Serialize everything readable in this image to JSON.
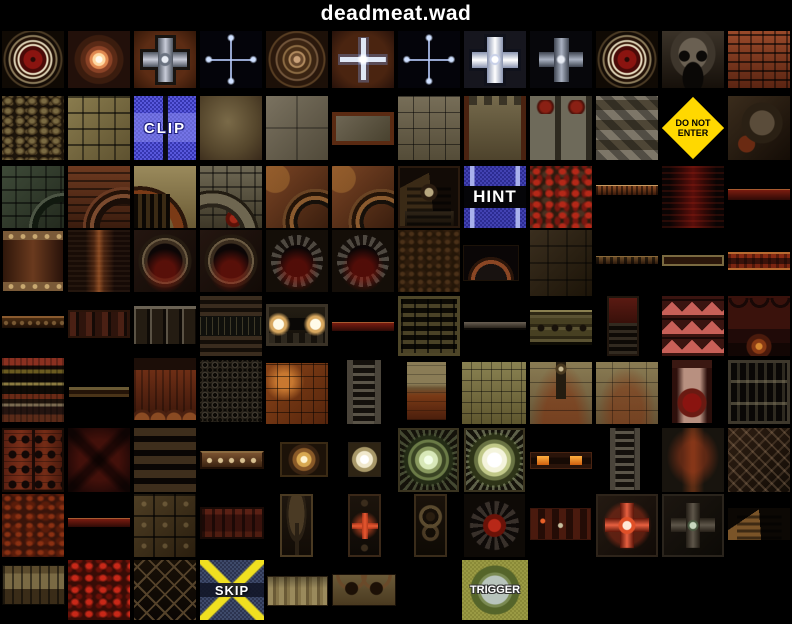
{
  "page": {
    "title": "deadmeat.wad"
  },
  "palette": {
    "background": "#000000",
    "title_text": "#ffffff",
    "clip_blue": "#4a4ad0",
    "hint_blue": "#3a3aa8",
    "warning_yellow": "#ffd800",
    "skip_navy": "#36405e",
    "skip_yellow": "#f0e020",
    "trigger_olive": "#90903c",
    "label_text": "#ffffff"
  },
  "tiles": [
    {
      "name": "red-medallion",
      "kind": "medallion-red",
      "x": 2,
      "y": 31,
      "w": 62,
      "h": 57
    },
    {
      "name": "glow-mandala",
      "kind": "mandala-glow",
      "x": 68,
      "y": 31,
      "w": 62,
      "h": 57
    },
    {
      "name": "metal-cross-rust",
      "kind": "cross-metal-rust",
      "x": 134,
      "y": 31,
      "w": 62,
      "h": 57
    },
    {
      "name": "faint-glow-cross",
      "kind": "cross-faint",
      "x": 200,
      "y": 31,
      "w": 62,
      "h": 57
    },
    {
      "name": "ring-mandala",
      "kind": "mandala-rings",
      "x": 266,
      "y": 31,
      "w": 62,
      "h": 57
    },
    {
      "name": "glow-cross-rust",
      "kind": "cross-glow-rust",
      "x": 332,
      "y": 31,
      "w": 62,
      "h": 57
    },
    {
      "name": "faint-glow-cross",
      "kind": "cross-faint",
      "x": 398,
      "y": 31,
      "w": 62,
      "h": 57
    },
    {
      "name": "bright-cross",
      "kind": "cross-bright",
      "x": 464,
      "y": 31,
      "w": 62,
      "h": 57
    },
    {
      "name": "metal-cross-dark",
      "kind": "cross-metal-dark",
      "x": 530,
      "y": 31,
      "w": 62,
      "h": 57
    },
    {
      "name": "red-medallion",
      "kind": "medallion-red",
      "x": 596,
      "y": 31,
      "w": 62,
      "h": 57
    },
    {
      "name": "metal-skull",
      "kind": "skull-metal",
      "x": 662,
      "y": 31,
      "w": 62,
      "h": 57
    },
    {
      "name": "red-brick",
      "kind": "brick-red",
      "x": 728,
      "y": 31,
      "w": 62,
      "h": 57
    },
    {
      "name": "gravel",
      "kind": "gravel",
      "x": 2,
      "y": 96,
      "w": 62,
      "h": 64
    },
    {
      "name": "stone-blocks",
      "kind": "stone-blocks",
      "x": 68,
      "y": 96,
      "w": 62,
      "h": 64
    },
    {
      "name": "clip-marker",
      "kind": "clip",
      "x": 134,
      "y": 96,
      "w": 62,
      "h": 64,
      "label": "CLIP"
    },
    {
      "name": "tan-plaster",
      "kind": "tan-smooth",
      "x": 200,
      "y": 96,
      "w": 62,
      "h": 64
    },
    {
      "name": "stone-slab",
      "kind": "stone-slab",
      "x": 266,
      "y": 96,
      "w": 62,
      "h": 64
    },
    {
      "name": "framed-panel",
      "kind": "framed-panel",
      "x": 332,
      "y": 112,
      "w": 62,
      "h": 33
    },
    {
      "name": "stone-grid",
      "kind": "stone-grid",
      "x": 398,
      "y": 96,
      "w": 62,
      "h": 64
    },
    {
      "name": "framed-stone-wall",
      "kind": "stone-framed-wall",
      "x": 464,
      "y": 96,
      "w": 62,
      "h": 64
    },
    {
      "name": "demon-face-columns",
      "kind": "columns-faces",
      "x": 530,
      "y": 96,
      "w": 62,
      "h": 64
    },
    {
      "name": "zigzag-wall",
      "kind": "zigzag",
      "x": 596,
      "y": 96,
      "w": 62,
      "h": 64
    },
    {
      "name": "do-not-enter-sign",
      "kind": "donotenter",
      "x": 662,
      "y": 96,
      "w": 62,
      "h": 64,
      "label": "DO NOT\nENTER"
    },
    {
      "name": "machine-skull-wall",
      "kind": "machine-skull",
      "x": 728,
      "y": 96,
      "w": 62,
      "h": 64
    },
    {
      "name": "green-arch-wall",
      "kind": "arch-green",
      "x": 2,
      "y": 166,
      "w": 62,
      "h": 62
    },
    {
      "name": "brick-arch-wall",
      "kind": "arch-brick",
      "x": 68,
      "y": 166,
      "w": 62,
      "h": 62
    },
    {
      "name": "tan-arch-bars",
      "kind": "arch-tan-bars",
      "x": 134,
      "y": 166,
      "w": 62,
      "h": 62
    },
    {
      "name": "stone-arch-wall",
      "kind": "arch-stone",
      "x": 200,
      "y": 166,
      "w": 62,
      "h": 62
    },
    {
      "name": "rust-gear-arch",
      "kind": "gear-rust",
      "x": 266,
      "y": 166,
      "w": 62,
      "h": 62
    },
    {
      "name": "rust-gear-arch",
      "kind": "gear-rust",
      "x": 332,
      "y": 166,
      "w": 62,
      "h": 62
    },
    {
      "name": "skull-shrine",
      "kind": "shrine-skull",
      "x": 398,
      "y": 166,
      "w": 62,
      "h": 62
    },
    {
      "name": "hint-marker",
      "kind": "hint",
      "x": 464,
      "y": 166,
      "w": 62,
      "h": 62,
      "label": "HINT"
    },
    {
      "name": "lava-veins",
      "kind": "lava-veins",
      "x": 530,
      "y": 166,
      "w": 62,
      "h": 62
    },
    {
      "name": "rust-strip",
      "kind": "strip-rust-thin",
      "x": 596,
      "y": 185,
      "w": 62,
      "h": 11
    },
    {
      "name": "red-glow-column",
      "kind": "red-glow-column",
      "x": 662,
      "y": 166,
      "w": 62,
      "h": 62
    },
    {
      "name": "red-strip",
      "kind": "strip-red-thin",
      "x": 728,
      "y": 189,
      "w": 62,
      "h": 11
    },
    {
      "name": "riveted-panel",
      "kind": "riveted-panel",
      "x": 2,
      "y": 230,
      "w": 62,
      "h": 62
    },
    {
      "name": "rust-streak",
      "kind": "rust-streak",
      "x": 68,
      "y": 230,
      "w": 62,
      "h": 62
    },
    {
      "name": "dark-portal",
      "kind": "portal-dark",
      "x": 134,
      "y": 230,
      "w": 62,
      "h": 62
    },
    {
      "name": "dark-portal",
      "kind": "portal-dark",
      "x": 200,
      "y": 230,
      "w": 62,
      "h": 62
    },
    {
      "name": "toothed-portal",
      "kind": "portal-tooth",
      "x": 266,
      "y": 230,
      "w": 62,
      "h": 62
    },
    {
      "name": "toothed-portal",
      "kind": "portal-tooth",
      "x": 332,
      "y": 230,
      "w": 62,
      "h": 62
    },
    {
      "name": "mottled-brown",
      "kind": "mottled-brown",
      "x": 398,
      "y": 230,
      "w": 62,
      "h": 62
    },
    {
      "name": "machine-arch",
      "kind": "arch-machine",
      "x": 463,
      "y": 245,
      "w": 56,
      "h": 36
    },
    {
      "name": "dark-stone",
      "kind": "dark-stone",
      "x": 530,
      "y": 230,
      "w": 62,
      "h": 66
    },
    {
      "name": "dotted-strip",
      "kind": "strip-dotted",
      "x": 596,
      "y": 256,
      "w": 62,
      "h": 9
    },
    {
      "name": "framed-strip",
      "kind": "strip-framed-thin",
      "x": 662,
      "y": 255,
      "w": 62,
      "h": 11
    },
    {
      "name": "red-banded-strip",
      "kind": "strip-red-banded",
      "x": 728,
      "y": 252,
      "w": 62,
      "h": 18
    },
    {
      "name": "chain-strip",
      "kind": "strip-chain",
      "x": 2,
      "y": 316,
      "w": 62,
      "h": 14
    },
    {
      "name": "slotted-strip",
      "kind": "strip-slots",
      "x": 68,
      "y": 310,
      "w": 62,
      "h": 28
    },
    {
      "name": "panel-strip",
      "kind": "strip-panels",
      "x": 134,
      "y": 306,
      "w": 62,
      "h": 38
    },
    {
      "name": "machinery-wall",
      "kind": "machinery-circuit",
      "x": 200,
      "y": 296,
      "w": 62,
      "h": 60
    },
    {
      "name": "headlight-panel",
      "kind": "headlights",
      "x": 266,
      "y": 304,
      "w": 62,
      "h": 42
    },
    {
      "name": "red-strip",
      "kind": "strip-red-thin",
      "x": 332,
      "y": 322,
      "w": 62,
      "h": 9
    },
    {
      "name": "slot-grate",
      "kind": "grate-slots",
      "x": 398,
      "y": 296,
      "w": 62,
      "h": 60
    },
    {
      "name": "gray-strip",
      "kind": "strip-gray-thin",
      "x": 464,
      "y": 322,
      "w": 62,
      "h": 8
    },
    {
      "name": "studded-strip",
      "kind": "strip-studded",
      "x": 530,
      "y": 310,
      "w": 62,
      "h": 35
    },
    {
      "name": "red-grate-panel",
      "kind": "panel-red-grate",
      "x": 607,
      "y": 296,
      "w": 32,
      "h": 60
    },
    {
      "name": "red-spike-wall",
      "kind": "spikes-red",
      "x": 662,
      "y": 296,
      "w": 62,
      "h": 60
    },
    {
      "name": "demon-arch-wall",
      "kind": "arches-demon",
      "x": 728,
      "y": 296,
      "w": 62,
      "h": 60
    },
    {
      "name": "layered-bands",
      "kind": "bands-multi",
      "x": 2,
      "y": 358,
      "w": 62,
      "h": 64
    },
    {
      "name": "banded-strip",
      "kind": "strip-banded-thin",
      "x": 68,
      "y": 386,
      "w": 62,
      "h": 12
    },
    {
      "name": "rust-pot-wall",
      "kind": "rust-pots-wall",
      "x": 134,
      "y": 358,
      "w": 62,
      "h": 62
    },
    {
      "name": "chainmail-mesh",
      "kind": "chainmail",
      "x": 200,
      "y": 360,
      "w": 62,
      "h": 62
    },
    {
      "name": "rust-tile-wall",
      "kind": "rust-tiles",
      "x": 266,
      "y": 363,
      "w": 62,
      "h": 61
    },
    {
      "name": "ladder",
      "kind": "ladder-narrow",
      "x": 347,
      "y": 360,
      "w": 34,
      "h": 64
    },
    {
      "name": "stained-half-wall",
      "kind": "half-tan-red",
      "x": 407,
      "y": 362,
      "w": 39,
      "h": 58
    },
    {
      "name": "olive-brick",
      "kind": "olive-brick",
      "x": 462,
      "y": 362,
      "w": 64,
      "h": 62
    },
    {
      "name": "tan-wall-skull-post",
      "kind": "tan-wall-skull",
      "x": 530,
      "y": 362,
      "w": 62,
      "h": 62
    },
    {
      "name": "tan-stained-wall",
      "kind": "tan-wall",
      "x": 596,
      "y": 362,
      "w": 62,
      "h": 62
    },
    {
      "name": "meat-column",
      "kind": "meat-column",
      "x": 672,
      "y": 360,
      "w": 40,
      "h": 63
    },
    {
      "name": "slatted-door",
      "kind": "door-slats",
      "x": 728,
      "y": 360,
      "w": 62,
      "h": 64
    },
    {
      "name": "red-door-panel",
      "kind": "red-door-panel",
      "x": 2,
      "y": 428,
      "w": 62,
      "h": 64
    },
    {
      "name": "dark-red-blotch",
      "kind": "dark-red-blotch",
      "x": 68,
      "y": 428,
      "w": 62,
      "h": 64
    },
    {
      "name": "waffle-grid",
      "kind": "waffle-grid",
      "x": 134,
      "y": 428,
      "w": 62,
      "h": 64
    },
    {
      "name": "riveted-strip",
      "kind": "strip-riveted",
      "x": 200,
      "y": 451,
      "w": 64,
      "h": 18
    },
    {
      "name": "small-gold-medallion",
      "kind": "medallion-small-gold",
      "x": 280,
      "y": 442,
      "w": 48,
      "h": 35
    },
    {
      "name": "small-white-medallion",
      "kind": "medallion-small-white",
      "x": 348,
      "y": 442,
      "w": 33,
      "h": 35
    },
    {
      "name": "glowing-mandala",
      "kind": "mandala-big",
      "x": 398,
      "y": 428,
      "w": 61,
      "h": 64
    },
    {
      "name": "bright-mandala",
      "kind": "mandala-bright",
      "x": 464,
      "y": 428,
      "w": 61,
      "h": 64
    },
    {
      "name": "light-strip",
      "kind": "strip-lights",
      "x": 530,
      "y": 452,
      "w": 62,
      "h": 17
    },
    {
      "name": "ladder",
      "kind": "ladder-narrow",
      "x": 610,
      "y": 428,
      "w": 30,
      "h": 62
    },
    {
      "name": "rust-streak-column",
      "kind": "rust-streak-column",
      "x": 662,
      "y": 428,
      "w": 62,
      "h": 64
    },
    {
      "name": "diamond-plate",
      "kind": "diamond-plate",
      "x": 728,
      "y": 428,
      "w": 62,
      "h": 64
    },
    {
      "name": "red-rough-wall",
      "kind": "red-rough",
      "x": 2,
      "y": 494,
      "w": 62,
      "h": 63
    },
    {
      "name": "red-strip",
      "kind": "strip-red-thin",
      "x": 68,
      "y": 518,
      "w": 62,
      "h": 9
    },
    {
      "name": "bronze-plates",
      "kind": "bronze-plates",
      "x": 134,
      "y": 494,
      "w": 62,
      "h": 63
    },
    {
      "name": "column-panel",
      "kind": "panel-columns",
      "x": 200,
      "y": 507,
      "w": 64,
      "h": 32
    },
    {
      "name": "narrow-arch-door",
      "kind": "narrow-arch-door",
      "x": 280,
      "y": 494,
      "w": 33,
      "h": 63
    },
    {
      "name": "narrow-red-cross-panel",
      "kind": "narrow-red-cross",
      "x": 348,
      "y": 494,
      "w": 33,
      "h": 63
    },
    {
      "name": "narrow-gear-panel",
      "kind": "narrow-gears",
      "x": 414,
      "y": 494,
      "w": 33,
      "h": 63
    },
    {
      "name": "gear-skull-medallion",
      "kind": "gear-skull",
      "x": 464,
      "y": 494,
      "w": 61,
      "h": 63
    },
    {
      "name": "machine-light-panel",
      "kind": "machine-lights",
      "x": 530,
      "y": 508,
      "w": 61,
      "h": 32
    },
    {
      "name": "red-cross-tile",
      "kind": "cross-red-tile",
      "x": 596,
      "y": 494,
      "w": 62,
      "h": 63
    },
    {
      "name": "dark-cross-tile",
      "kind": "cross-dark-tile",
      "x": 662,
      "y": 494,
      "w": 62,
      "h": 63
    },
    {
      "name": "step-pyramid",
      "kind": "pyramid-steps",
      "x": 728,
      "y": 508,
      "w": 62,
      "h": 32
    },
    {
      "name": "totem-strip",
      "kind": "totems-strip",
      "x": 2,
      "y": 565,
      "w": 63,
      "h": 40
    },
    {
      "name": "red-lava-wall",
      "kind": "lava-red2",
      "x": 68,
      "y": 560,
      "w": 62,
      "h": 60
    },
    {
      "name": "diamond-mesh",
      "kind": "mesh-diamond",
      "x": 134,
      "y": 560,
      "w": 62,
      "h": 60
    },
    {
      "name": "skip-marker",
      "kind": "skip",
      "x": 200,
      "y": 560,
      "w": 64,
      "h": 60,
      "label": "SKIP"
    },
    {
      "name": "carved-figures-strip",
      "kind": "figures-strip",
      "x": 267,
      "y": 576,
      "w": 61,
      "h": 30
    },
    {
      "name": "demon-faces-strip",
      "kind": "faces-strip",
      "x": 332,
      "y": 574,
      "w": 64,
      "h": 32
    },
    {
      "name": "trigger-marker",
      "kind": "trigger",
      "x": 462,
      "y": 560,
      "w": 66,
      "h": 60,
      "label": "TRIGGER"
    }
  ]
}
